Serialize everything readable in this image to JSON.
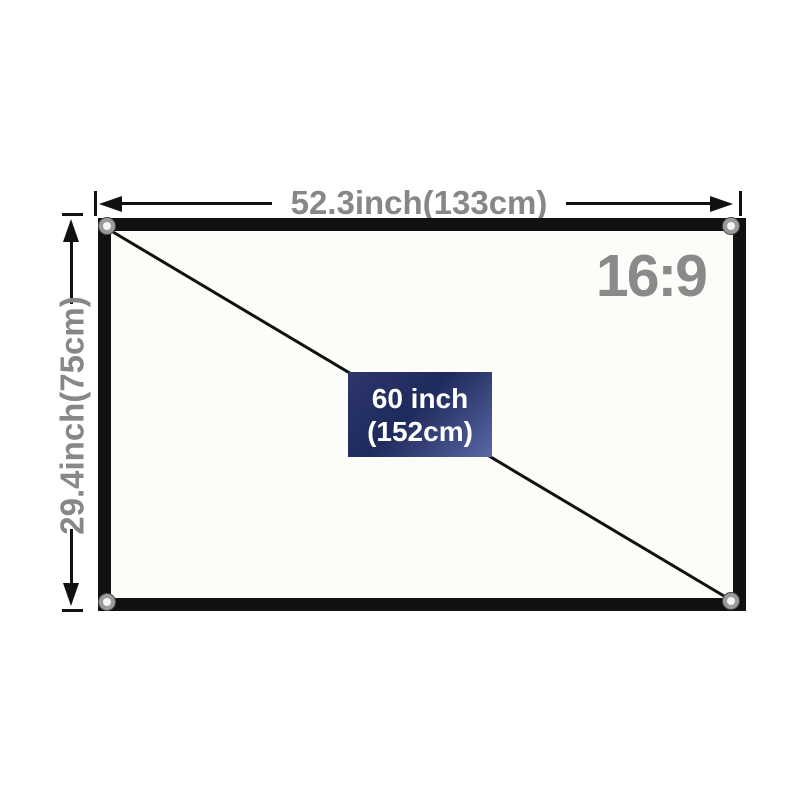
{
  "diagram": {
    "width_label": "52.3inch(133cm)",
    "height_label": "29.4inch(75cm)",
    "aspect_ratio_label": "16:9",
    "diagonal_size": {
      "line1": "60 inch",
      "line2": "(152cm)"
    },
    "colors": {
      "label_gray": "#878787",
      "aspect_gray": "#8a8a8a",
      "line_black": "#111111",
      "frame_black": "#111111",
      "screen_fill": "#fcfcf8",
      "grommet_ring": "#9b9b9b",
      "badge_gradient_start": "#2c366c",
      "badge_gradient_mid": "#1f2a5c",
      "badge_gradient_end": "#5a67a4",
      "badge_text": "#ffffff"
    }
  }
}
